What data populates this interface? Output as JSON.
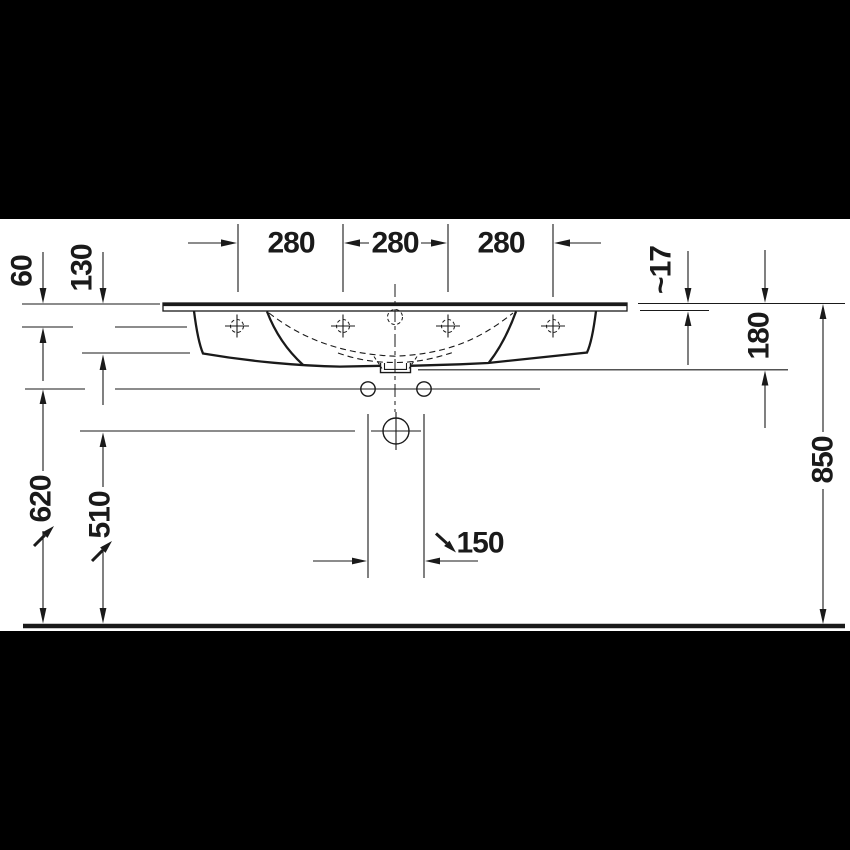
{
  "colors": {
    "background": "#ffffff",
    "band": "#000000",
    "line": "#1a1a1a"
  },
  "drawing": {
    "kind": "washbasin front elevation technical drawing",
    "dims": {
      "top": [
        "280",
        "280",
        "280"
      ],
      "d60": "60",
      "d130": "130",
      "d620": "620",
      "d510": "510",
      "d17": "~17",
      "d180": "180",
      "d850": "850",
      "d150": "150"
    }
  }
}
